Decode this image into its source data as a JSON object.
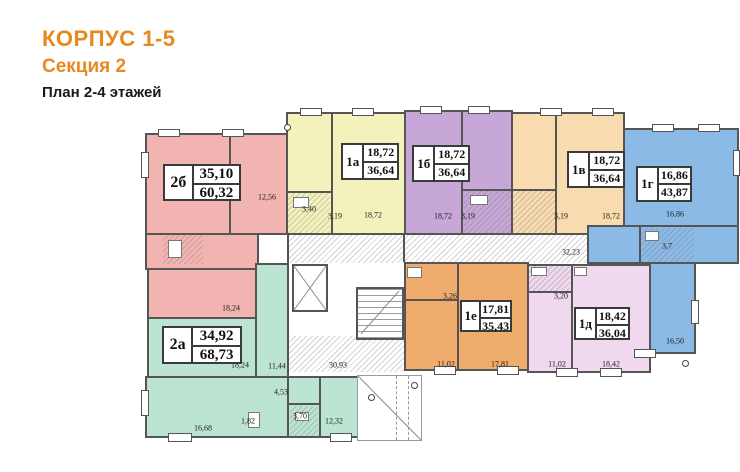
{
  "title": {
    "building": "КОРПУС 1-5",
    "section": "Секция 2",
    "plan": "План 2-4 этажей"
  },
  "colors": {
    "accent_orange": "#e8891f",
    "title_text": "#1a1a1a",
    "wall": "#555555"
  },
  "apartments": [
    {
      "id": "2б",
      "living_area": "35,10",
      "total_area": "60,32",
      "color": "#f2b4b0",
      "box": {
        "x": 163,
        "y": 164,
        "w": 78,
        "h": 37
      }
    },
    {
      "id": "1а",
      "living_area": "18,72",
      "total_area": "36,64",
      "color": "#f4f2bc",
      "box": {
        "x": 341,
        "y": 143,
        "w": 58,
        "h": 37
      }
    },
    {
      "id": "1б",
      "living_area": "18,72",
      "total_area": "36,64",
      "color": "#c7a6d8",
      "box": {
        "x": 412,
        "y": 145,
        "w": 58,
        "h": 37
      }
    },
    {
      "id": "1в",
      "living_area": "18,72",
      "total_area": "36,64",
      "color": "#f8dbae",
      "box": {
        "x": 567,
        "y": 151,
        "w": 58,
        "h": 37
      }
    },
    {
      "id": "1г",
      "living_area": "16,86",
      "total_area": "43,87",
      "color": "#8cbae7",
      "box": {
        "x": 636,
        "y": 166,
        "w": 56,
        "h": 36
      }
    },
    {
      "id": "2а",
      "living_area": "34,92",
      "total_area": "68,73",
      "color": "#bce4d3",
      "box": {
        "x": 162,
        "y": 326,
        "w": 80,
        "h": 38
      }
    },
    {
      "id": "1е",
      "living_area": "17,81",
      "total_area": "35,43",
      "color": "#efac6c",
      "box": {
        "x": 460,
        "y": 300,
        "w": 52,
        "h": 32
      }
    },
    {
      "id": "1д",
      "living_area": "18,42",
      "total_area": "36,04",
      "color": "#f0d8ee",
      "box": {
        "x": 574,
        "y": 307,
        "w": 56,
        "h": 33
      }
    }
  ],
  "room_labels": [
    {
      "text": "12,56",
      "x": 267,
      "y": 197
    },
    {
      "text": "18,24",
      "x": 231,
      "y": 308
    },
    {
      "text": "3,40",
      "x": 309,
      "y": 209
    },
    {
      "text": "3,19",
      "x": 335,
      "y": 216
    },
    {
      "text": "18,72",
      "x": 373,
      "y": 215
    },
    {
      "text": "18,72",
      "x": 443,
      "y": 216
    },
    {
      "text": "3,19",
      "x": 468,
      "y": 216
    },
    {
      "text": "3,19",
      "x": 561,
      "y": 216
    },
    {
      "text": "18,72",
      "x": 611,
      "y": 216
    },
    {
      "text": "16,86",
      "x": 675,
      "y": 214
    },
    {
      "text": "3,7",
      "x": 667,
      "y": 246
    },
    {
      "text": "32,23",
      "x": 571,
      "y": 252
    },
    {
      "text": "16,50",
      "x": 675,
      "y": 341
    },
    {
      "text": "30,93",
      "x": 338,
      "y": 365
    },
    {
      "text": "18,24",
      "x": 240,
      "y": 365
    },
    {
      "text": "11,44",
      "x": 277,
      "y": 366
    },
    {
      "text": "4,53",
      "x": 281,
      "y": 392
    },
    {
      "text": "3,70",
      "x": 300,
      "y": 416
    },
    {
      "text": "1,82",
      "x": 248,
      "y": 421
    },
    {
      "text": "16,68",
      "x": 203,
      "y": 428
    },
    {
      "text": "12,32",
      "x": 334,
      "y": 421
    },
    {
      "text": "3,26",
      "x": 450,
      "y": 296
    },
    {
      "text": "11,02",
      "x": 446,
      "y": 364
    },
    {
      "text": "17,81",
      "x": 500,
      "y": 364
    },
    {
      "text": "3,20",
      "x": 561,
      "y": 296
    },
    {
      "text": "11,02",
      "x": 557,
      "y": 364
    },
    {
      "text": "18,42",
      "x": 611,
      "y": 364
    }
  ]
}
